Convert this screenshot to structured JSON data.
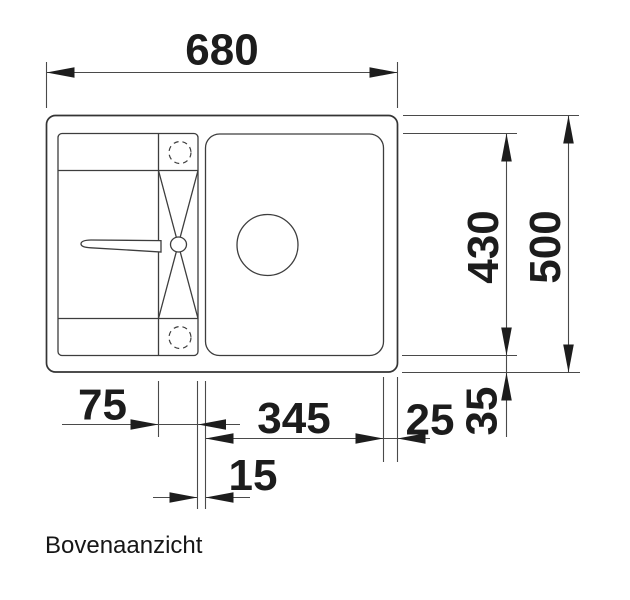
{
  "page": {
    "background_color": "#ffffff",
    "ink_color": "#1d1d1d",
    "line_color": "#3d3d3d"
  },
  "drawing": {
    "caption": "Bovenaanzicht",
    "view": "top view technical drawing of kitchen sink",
    "dimensions": {
      "overall_width": "680",
      "overall_depth": "500",
      "inner_depth": "430",
      "strip_width": "75",
      "bowl_width": "345",
      "bowl_to_right_edge": "25",
      "inner_to_front_edge": "35",
      "strip_to_bowl_gap": "15"
    }
  }
}
